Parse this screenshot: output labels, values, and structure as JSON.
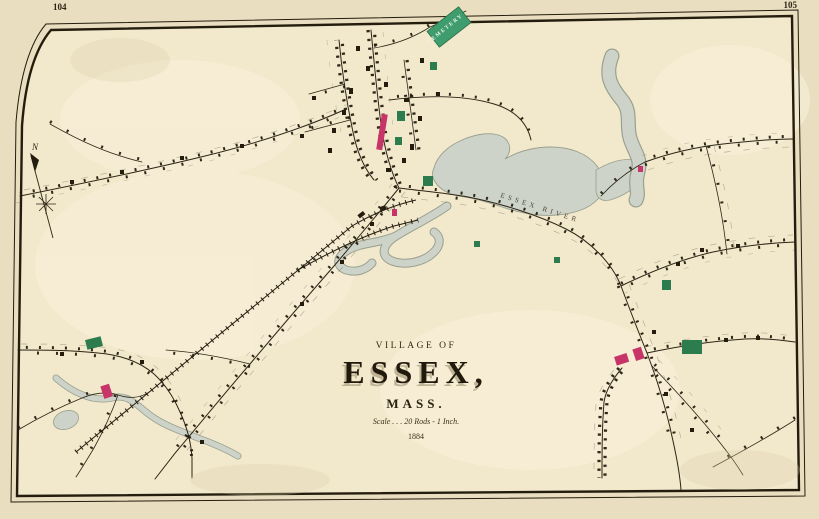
{
  "sheet": {
    "left_page_number": "104",
    "right_page_number": "105"
  },
  "title_block": {
    "kicker": "VILLAGE OF",
    "title": "ESSEX,",
    "state": "MASS.",
    "scale": "Scale . . . 20 Rods - 1 Inch.",
    "year": "1884"
  },
  "labels": {
    "cemetery": "CEMETERY",
    "river": "ESSEX RIVER",
    "compass_north": "N"
  },
  "colors": {
    "paper_margin": "#e9debf",
    "map_ground": "#f2e8cc",
    "field_light": "#f7efd8",
    "ink": "#2c2514",
    "water": "#cdd3c8",
    "water_edge": "#99a08f",
    "building_pink": "#c73467",
    "building_green": "#2d7c4e",
    "cemetery_green": "#3f9c6d"
  }
}
